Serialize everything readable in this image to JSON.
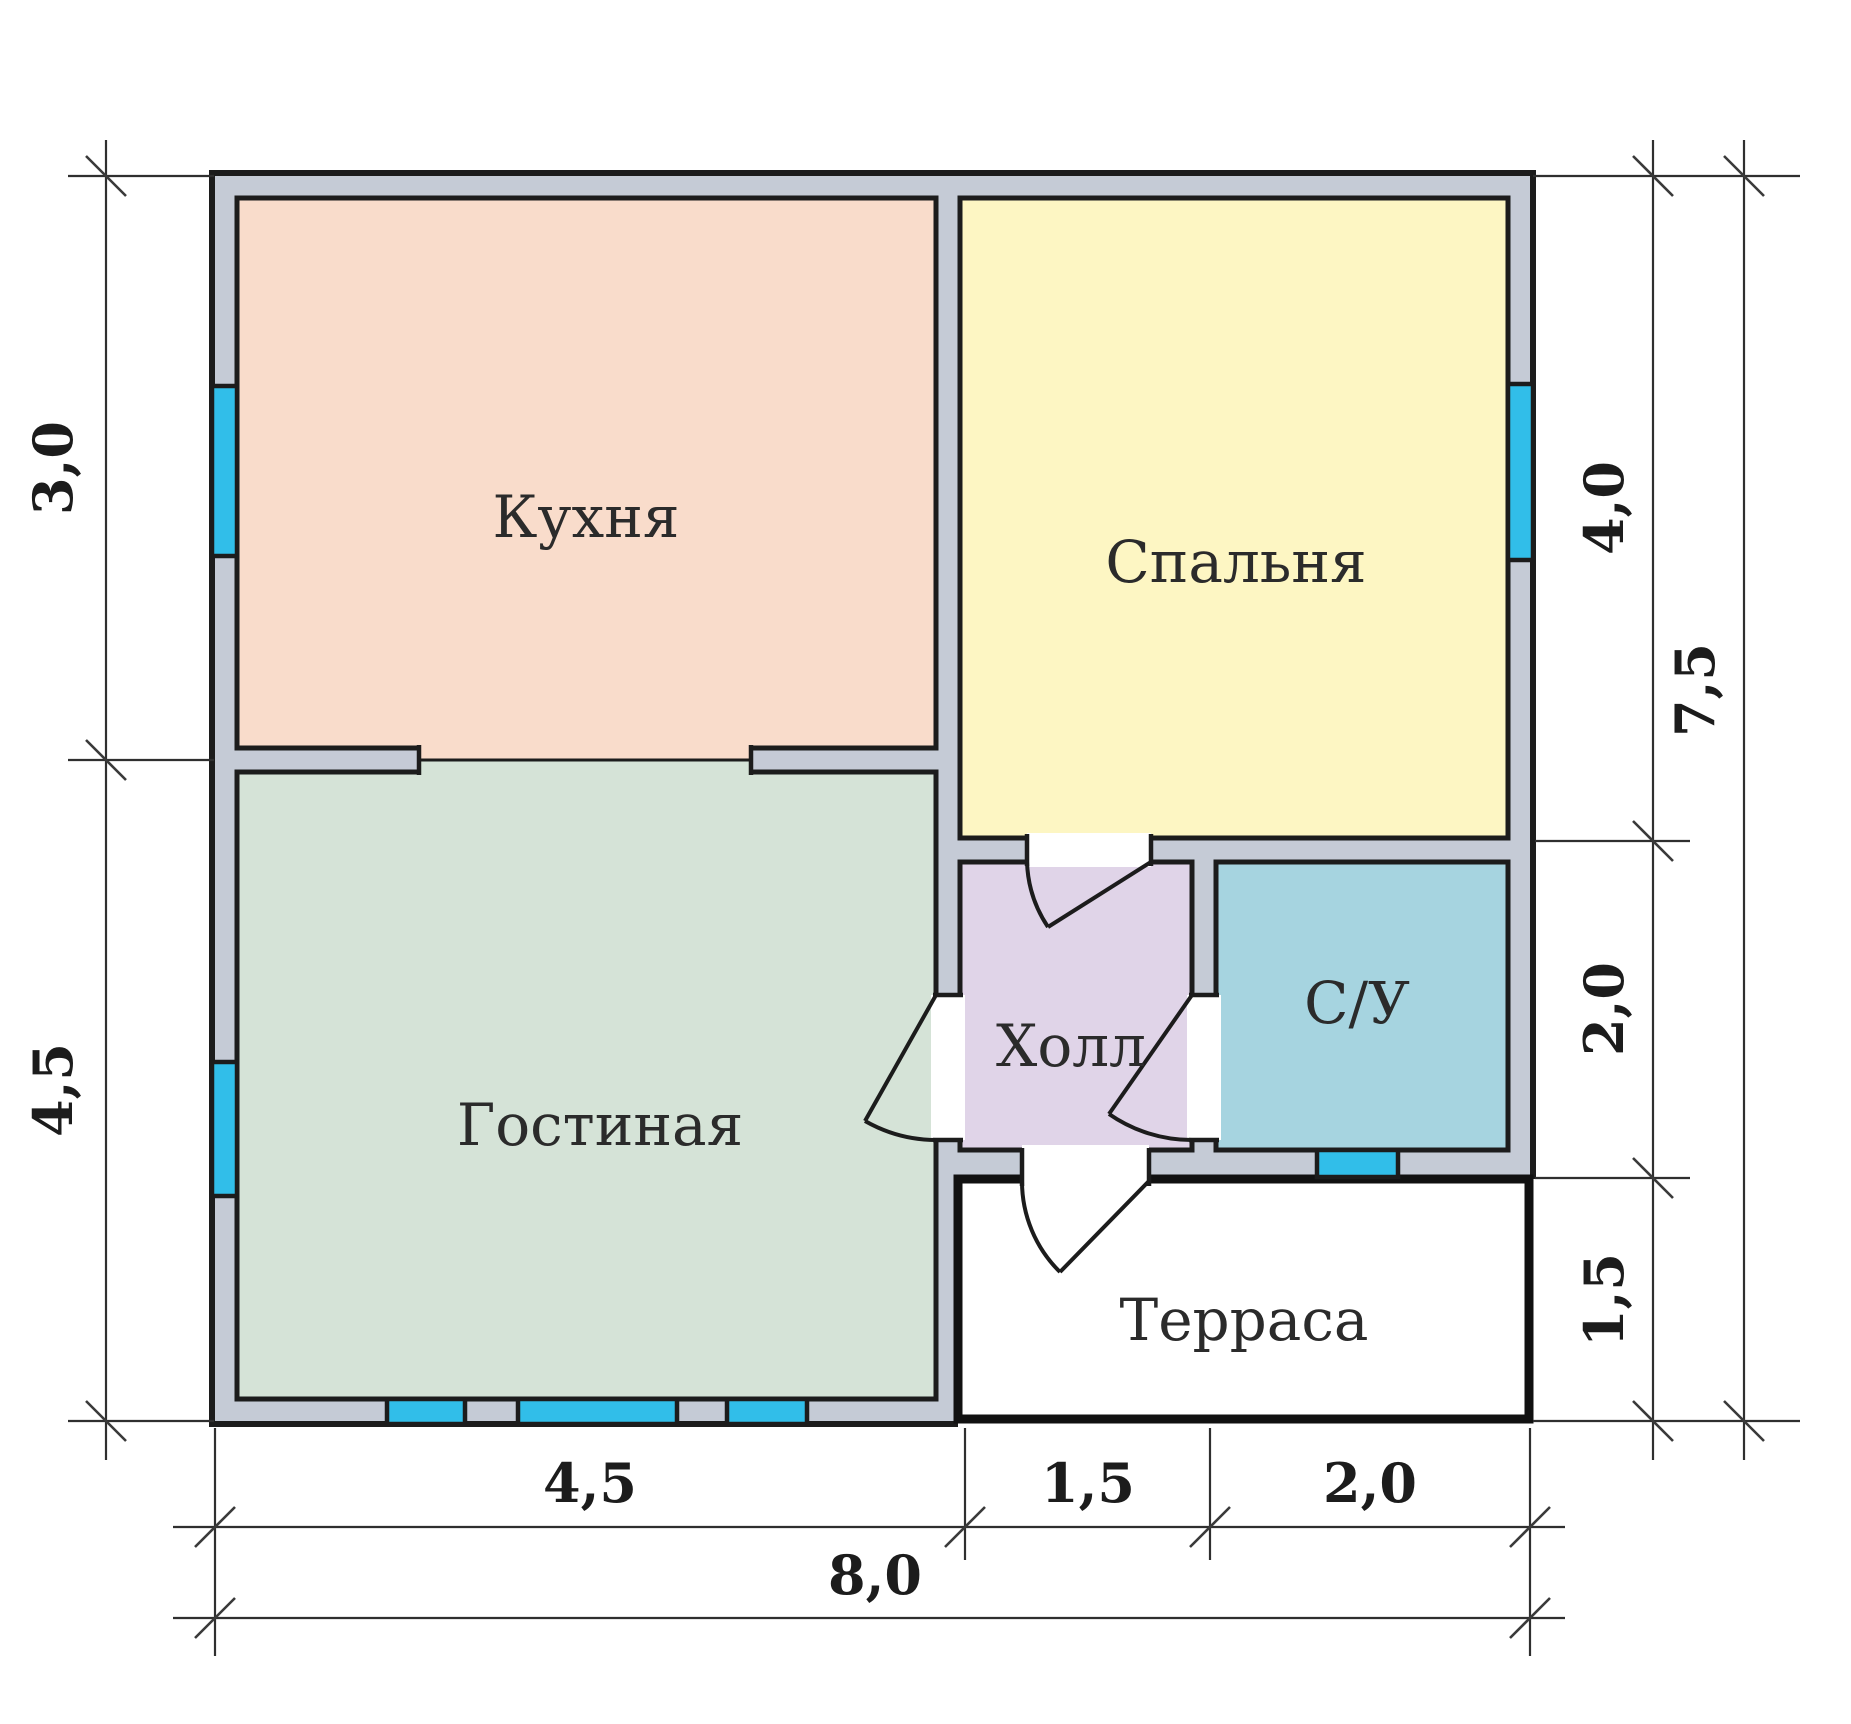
{
  "plan": {
    "rooms": {
      "kitchen": {
        "label": "Кухня",
        "color": "#f9dccb"
      },
      "bedroom": {
        "label": "Спальня",
        "color": "#fdf6c3"
      },
      "living": {
        "label": "Гостиная",
        "color": "#d5e3d7"
      },
      "hall": {
        "label": "Холл",
        "color": "#e0d4e8"
      },
      "bathroom": {
        "label": "С/У",
        "color": "#a6d4e0"
      },
      "terrace": {
        "label": "Терраса",
        "color": "#ffffff"
      }
    },
    "dimensions": {
      "left": [
        {
          "label": "3,0"
        },
        {
          "label": "4,5"
        }
      ],
      "right_inner": [
        {
          "label": "4,0"
        },
        {
          "label": "2,0"
        },
        {
          "label": "1,5"
        }
      ],
      "right_outer": [
        {
          "label": "7,5"
        }
      ],
      "bottom_inner": [
        {
          "label": "4,5"
        },
        {
          "label": "1,5"
        },
        {
          "label": "2,0"
        }
      ],
      "bottom_outer": [
        {
          "label": "8,0"
        }
      ]
    },
    "palette": {
      "wall": "#c5cbd6",
      "window": "#31bee9",
      "line": "#1c1c1c"
    }
  }
}
